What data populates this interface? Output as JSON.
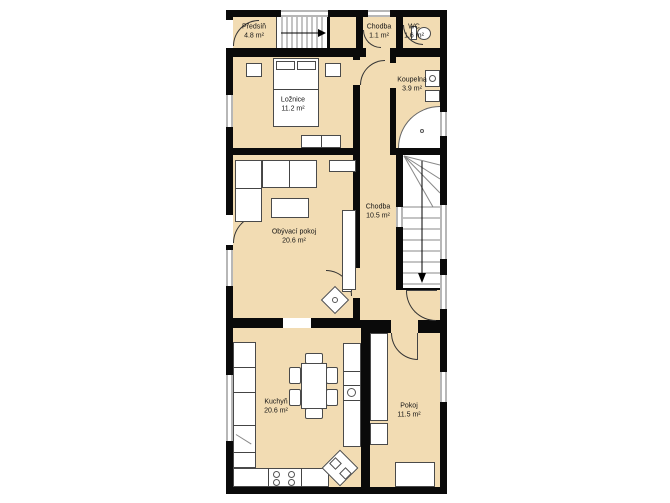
{
  "plan": {
    "rooms": {
      "predsin": {
        "name": "Předsíň",
        "area": "4.8 m²"
      },
      "chodba_top": {
        "name": "Chodba",
        "area": "1.1 m²"
      },
      "wc": {
        "name": "WC",
        "area": "1.6 m²"
      },
      "loznice": {
        "name": "Ložnice",
        "area": "11.2 m²"
      },
      "koupelna": {
        "name": "Koupelna",
        "area": "3.9 m²"
      },
      "chodba": {
        "name": "Chodba",
        "area": "10.5 m²"
      },
      "obyvaci_pokoj": {
        "name": "Obývací pokoj",
        "area": "20.6 m²"
      },
      "kuchyn": {
        "name": "Kuchyň",
        "area": "20.6 m²"
      },
      "pokoj": {
        "name": "Pokoj",
        "area": "11.5 m²"
      }
    },
    "colors": {
      "floor": "#f2dcb3",
      "wall": "#0a0a0a",
      "fixture_fill": "#ffffff",
      "window_frame": "#b7b7b7"
    }
  }
}
